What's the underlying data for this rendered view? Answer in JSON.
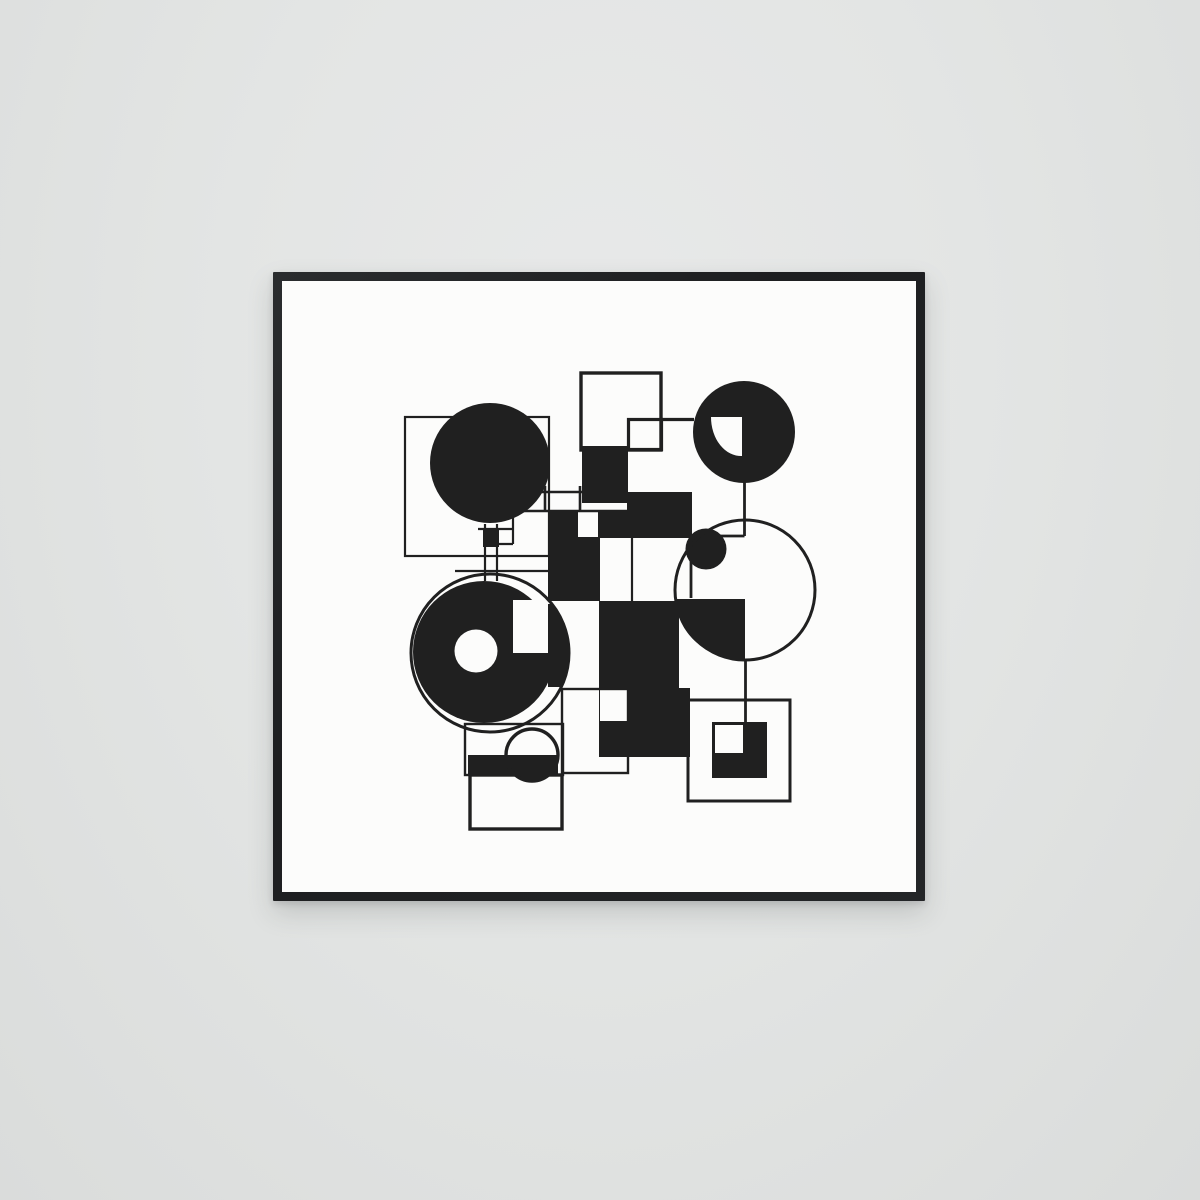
{
  "scene": {
    "description_labels": {
      "wall": "wall",
      "frame": "picture-frame",
      "canvas": "art-print-canvas"
    }
  },
  "palette": {
    "wall": "#e3e5e4",
    "frame": "#1e1f21",
    "paper": "#fcfcfb",
    "ink": "#202020"
  },
  "artwork": {
    "shapes": [
      {
        "name": "square-outline-top-left",
        "type": "rect",
        "x": 405,
        "y": 417,
        "w": 144,
        "h": 139,
        "stroke": "ink",
        "sw": 2.2
      },
      {
        "name": "disc-top-left",
        "type": "circle",
        "cx": 490,
        "cy": 463,
        "r": 60,
        "fill": "ink"
      },
      {
        "name": "disc-top-right",
        "type": "circle",
        "cx": 744,
        "cy": 432,
        "r": 51,
        "fill": "ink"
      },
      {
        "name": "fan-notch-top-right",
        "type": "path",
        "d": "M742,417 L742,456 A30,39 0 0 1 711,417 Z",
        "fill": "paper"
      },
      {
        "name": "square-a-outline",
        "type": "rect",
        "x": 581,
        "y": 373,
        "w": 80,
        "h": 77,
        "stroke": "ink",
        "sw": 3.4
      },
      {
        "name": "square-b-outline",
        "type": "rect",
        "x": 628.5,
        "y": 419.5,
        "w": 33,
        "h": 30,
        "stroke": "ink",
        "sw": 3.2
      },
      {
        "name": "line-b-top-extension",
        "type": "line",
        "x1": 661,
        "y1": 419.5,
        "x2": 694,
        "y2": 419.5,
        "stroke": "ink",
        "sw": 3.2
      },
      {
        "name": "rect-black-upper",
        "type": "rect",
        "x": 582,
        "y": 446,
        "w": 46,
        "h": 57,
        "fill": "ink"
      },
      {
        "name": "rect-black-mid-right",
        "type": "rect",
        "x": 627,
        "y": 492,
        "w": 65,
        "h": 46,
        "fill": "ink"
      },
      {
        "name": "poly-black-center",
        "type": "path",
        "d": "M548,512 H627 V538 H600 V601 H548 Z",
        "fill": "ink"
      },
      {
        "name": "notch-white-center",
        "type": "rect",
        "x": 578,
        "y": 512,
        "w": 20,
        "h": 25,
        "fill": "paper"
      },
      {
        "name": "poly-black-lower",
        "type": "path",
        "d": "M599,601 H679 V688 H690 V757 H599 Z",
        "fill": "ink"
      },
      {
        "name": "notch-white-lower",
        "type": "rect",
        "x": 600,
        "y": 690,
        "w": 28,
        "h": 31,
        "fill": "paper"
      },
      {
        "name": "disc-bottom-left",
        "type": "circle",
        "cx": 484,
        "cy": 652,
        "r": 71,
        "fill": "ink"
      },
      {
        "name": "notch-white-disc",
        "type": "rect",
        "x": 513,
        "y": 600,
        "w": 36,
        "h": 53,
        "fill": "paper"
      },
      {
        "name": "hole-white-disc",
        "type": "circle",
        "cx": 476,
        "cy": 651,
        "r": 21.5,
        "fill": "paper"
      },
      {
        "name": "arc-segment-right-of-disc",
        "type": "path",
        "d": "M548,604 L552,604 A79,79 0 0 1 561,687 L548,687 Z",
        "fill": "ink"
      },
      {
        "name": "circle-outline-bottom-left",
        "type": "circle",
        "cx": 490,
        "cy": 653,
        "r": 79,
        "stroke": "ink",
        "sw": 3
      },
      {
        "name": "quarter-disc-right",
        "type": "path",
        "d": "M745,599 L676,599 A69,61 0 0 0 745,660 Z",
        "fill": "ink"
      },
      {
        "name": "blob-disc-right",
        "type": "circle",
        "cx": 706,
        "cy": 549,
        "r": 20.5,
        "fill": "ink"
      },
      {
        "name": "circle-outline-right",
        "type": "circle",
        "cx": 745,
        "cy": 590,
        "r": 70,
        "stroke": "ink",
        "sw": 3
      },
      {
        "name": "bar-bottom-left",
        "type": "rect",
        "x": 468,
        "y": 755,
        "w": 90,
        "h": 20,
        "fill": "ink"
      },
      {
        "name": "semicircle-small-bottom",
        "type": "path",
        "d": "M506,755 A26,26 0 0 0 558,755 Z",
        "fill": "ink"
      },
      {
        "name": "circle-outline-small",
        "type": "circle",
        "cx": 532,
        "cy": 755,
        "r": 26,
        "stroke": "ink",
        "sw": 3.4
      },
      {
        "name": "rect-outline-r1",
        "type": "rect",
        "x": 465,
        "y": 724,
        "w": 98,
        "h": 51,
        "stroke": "ink",
        "sw": 2.4
      },
      {
        "name": "rect-outline-r2",
        "type": "rect",
        "x": 470,
        "y": 775,
        "w": 92,
        "h": 54,
        "stroke": "ink",
        "sw": 3.4
      },
      {
        "name": "rect-outline-r3",
        "type": "rect",
        "x": 562,
        "y": 689,
        "w": 66,
        "h": 84,
        "stroke": "ink",
        "sw": 2.4
      },
      {
        "name": "square-outline-bottom-right",
        "type": "rect",
        "x": 688,
        "y": 700,
        "w": 102,
        "h": 101,
        "stroke": "ink",
        "sw": 3
      },
      {
        "name": "square-black-bottom-right",
        "type": "rect",
        "x": 712,
        "y": 722,
        "w": 55,
        "h": 56,
        "fill": "ink"
      },
      {
        "name": "square-white-inner",
        "type": "rect",
        "x": 714,
        "y": 724,
        "w": 30,
        "h": 30,
        "fill": "paper",
        "stroke": "ink",
        "sw": 2
      },
      {
        "name": "mini-square-cross",
        "type": "rect",
        "x": 483,
        "y": 528,
        "w": 16,
        "h": 19,
        "fill": "ink"
      },
      {
        "name": "line-v-stem-left",
        "type": "line",
        "x1": 485,
        "y1": 524,
        "x2": 485,
        "y2": 581,
        "stroke": "ink",
        "sw": 2.2
      },
      {
        "name": "line-v-stem-right",
        "type": "line",
        "x1": 497,
        "y1": 524,
        "x2": 497,
        "y2": 581,
        "stroke": "ink",
        "sw": 2.2
      },
      {
        "name": "line-h-upper",
        "type": "line",
        "x1": 478,
        "y1": 529,
        "x2": 513,
        "y2": 529,
        "stroke": "ink",
        "sw": 2.2
      },
      {
        "name": "line-h-lower",
        "type": "line",
        "x1": 483,
        "y1": 544,
        "x2": 513,
        "y2": 544,
        "stroke": "ink",
        "sw": 2.2
      },
      {
        "name": "line-h-long",
        "type": "line",
        "x1": 455,
        "y1": 571,
        "x2": 549,
        "y2": 571,
        "stroke": "ink",
        "sw": 2.2
      },
      {
        "name": "line-v-short",
        "type": "line",
        "x1": 513,
        "y1": 492,
        "x2": 513,
        "y2": 544,
        "stroke": "ink",
        "sw": 2.2
      },
      {
        "name": "line-stripe-top",
        "type": "line",
        "x1": 513,
        "y1": 492,
        "x2": 627,
        "y2": 492,
        "stroke": "ink",
        "sw": 2.6
      },
      {
        "name": "line-stripe-bottom",
        "type": "line",
        "x1": 513,
        "y1": 511,
        "x2": 627,
        "y2": 511,
        "stroke": "ink",
        "sw": 2.6
      },
      {
        "name": "line-stripe-v1",
        "type": "line",
        "x1": 545,
        "y1": 486,
        "x2": 545,
        "y2": 512,
        "stroke": "ink",
        "sw": 2.6
      },
      {
        "name": "line-stripe-v2",
        "type": "line",
        "x1": 580,
        "y1": 486,
        "x2": 580,
        "y2": 512,
        "stroke": "ink",
        "sw": 2.6
      },
      {
        "name": "line-v-gap",
        "type": "line",
        "x1": 632,
        "y1": 538,
        "x2": 632,
        "y2": 601,
        "stroke": "ink",
        "sw": 2.2
      },
      {
        "name": "line-v-circle-drop",
        "type": "line",
        "x1": 744.5,
        "y1": 482,
        "x2": 744.5,
        "y2": 536,
        "stroke": "ink",
        "sw": 2.8
      },
      {
        "name": "line-h-step",
        "type": "line",
        "x1": 691,
        "y1": 536,
        "x2": 744.5,
        "y2": 536,
        "stroke": "ink",
        "sw": 2.8
      },
      {
        "name": "line-v-step",
        "type": "line",
        "x1": 691,
        "y1": 536,
        "x2": 691,
        "y2": 598,
        "stroke": "ink",
        "sw": 2.8
      },
      {
        "name": "line-v-lower-drop",
        "type": "line",
        "x1": 745.5,
        "y1": 660,
        "x2": 745.5,
        "y2": 722,
        "stroke": "ink",
        "sw": 2.8
      }
    ]
  }
}
